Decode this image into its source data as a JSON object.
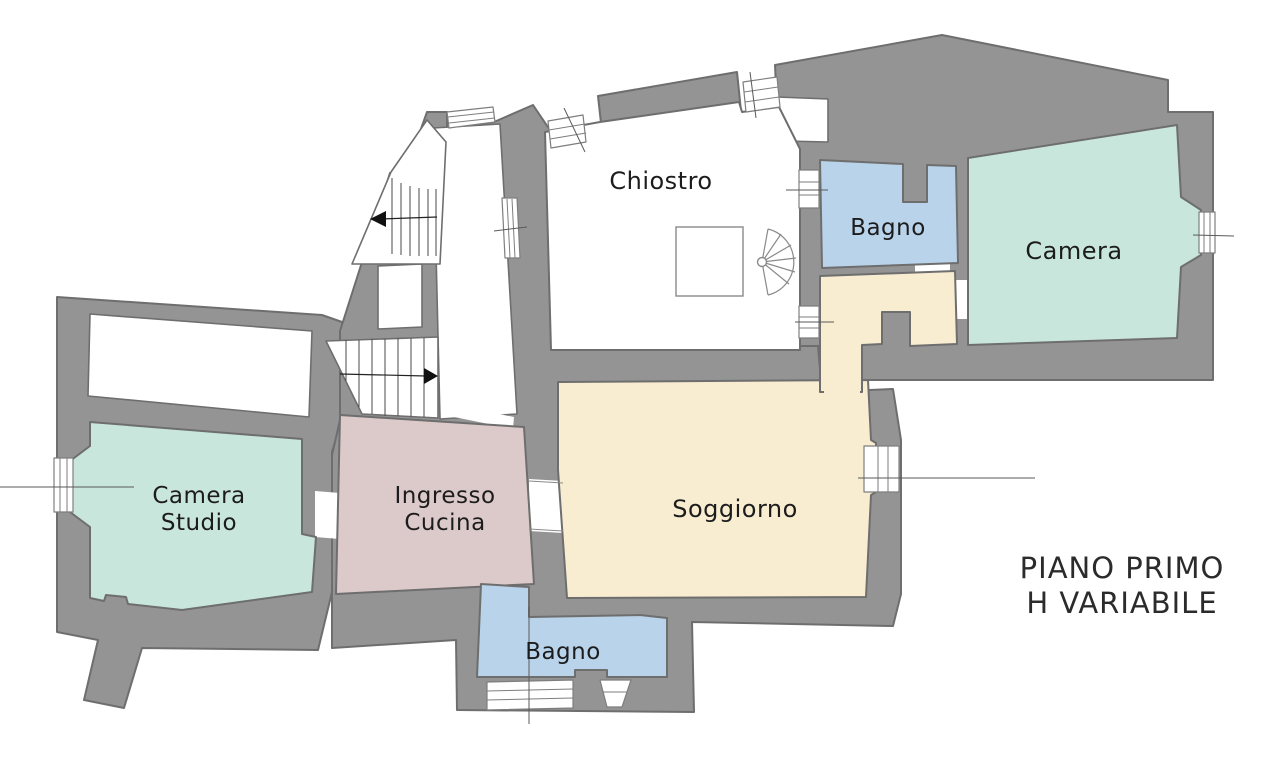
{
  "floorplan": {
    "plan_title_line1": "PIANO PRIMO",
    "plan_title_line2": "H VARIABILE",
    "rooms": {
      "chiostro": {
        "label": "Chiostro",
        "color": "#ffffff"
      },
      "bagno_top": {
        "label": "Bagno",
        "color": "#b9d3eb"
      },
      "camera": {
        "label": "Camera",
        "color": "#c9e6dc"
      },
      "camera_studio": {
        "label_line1": "Camera",
        "label_line2": "Studio",
        "color": "#c9e6dc"
      },
      "ingresso_cucina": {
        "label_line1": "Ingresso",
        "label_line2": "Cucina",
        "color": "#dbcac9"
      },
      "soggiorno": {
        "label": "Soggiorno",
        "color": "#f8ecd1"
      },
      "hallway": {
        "color": "#f8ecd1"
      },
      "bagno_bottom": {
        "label": "Bagno",
        "color": "#b9d3eb"
      }
    },
    "colors": {
      "background": "#ffffff",
      "wall_fill": "#949494",
      "wall_stroke": "#6e6e6e",
      "label_text": "#1c1c1c",
      "title_text": "#2b2b2b"
    }
  }
}
